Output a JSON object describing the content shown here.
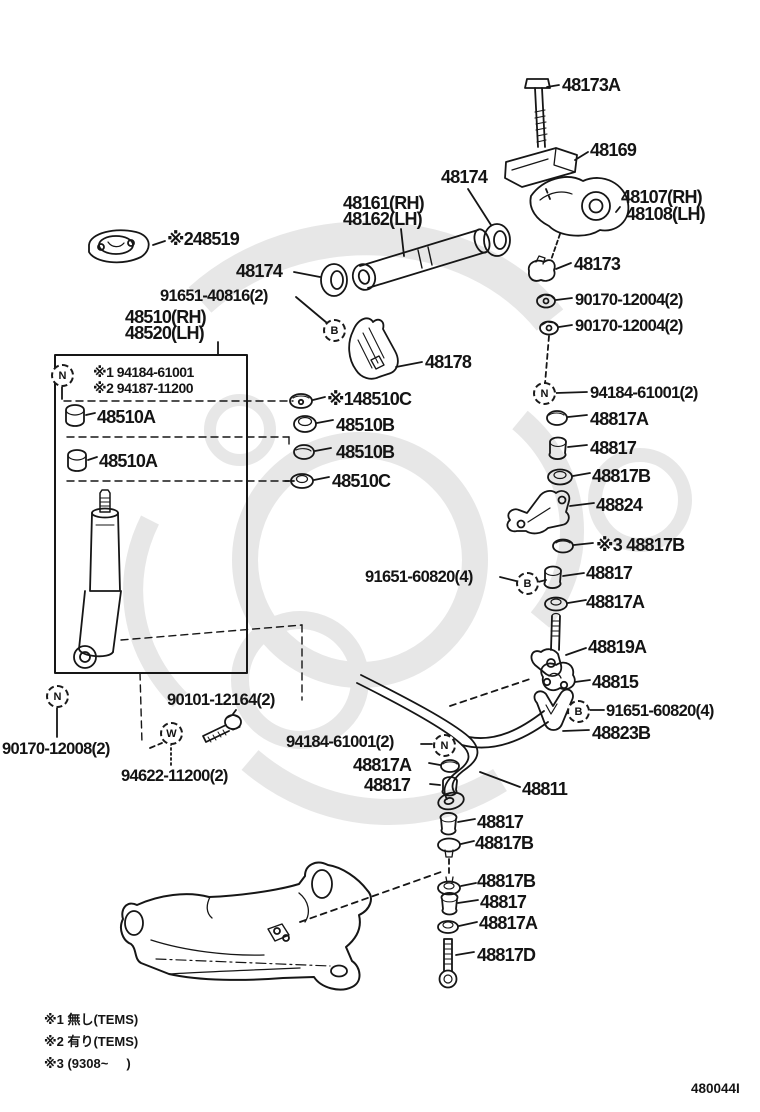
{
  "figure": {
    "code": "480044I"
  },
  "labels": [
    {
      "text": "48173A"
    },
    {
      "text": "48169"
    },
    {
      "text": "48174"
    },
    {
      "text": "48161(RH)"
    },
    {
      "text": "48162(LH)"
    },
    {
      "text": "48107(RH)"
    },
    {
      "text": "48108(LH)"
    },
    {
      "text": "※248519"
    },
    {
      "text": "48174"
    },
    {
      "text": "48173"
    },
    {
      "text": "91651-40816(2)"
    },
    {
      "text": "90170-12004(2)"
    },
    {
      "text": "90170-12004(2)"
    },
    {
      "text": "48510(RH)"
    },
    {
      "text": "48520(LH)"
    },
    {
      "text": "48178"
    },
    {
      "text": "※1 94184-61001"
    },
    {
      "text": "※2 94187-11200"
    },
    {
      "text": "※148510C"
    },
    {
      "text": "48510B"
    },
    {
      "text": "48510A"
    },
    {
      "text": "48510B"
    },
    {
      "text": "48510A"
    },
    {
      "text": "48510C"
    },
    {
      "text": "94184-61001(2)"
    },
    {
      "text": "48817A"
    },
    {
      "text": "48817"
    },
    {
      "text": "48817B"
    },
    {
      "text": "48824"
    },
    {
      "text": "※3 48817B"
    },
    {
      "text": "91651-60820(4)"
    },
    {
      "text": "48817"
    },
    {
      "text": "48817A"
    },
    {
      "text": "48819A"
    },
    {
      "text": "48815"
    },
    {
      "text": "91651-60820(4)"
    },
    {
      "text": "48823B"
    },
    {
      "text": "90101-12164(2)"
    },
    {
      "text": "90170-12008(2)"
    },
    {
      "text": "94622-11200(2)"
    },
    {
      "text": "94184-61001(2)"
    },
    {
      "text": "48817A"
    },
    {
      "text": "48817"
    },
    {
      "text": "48811"
    },
    {
      "text": "48817"
    },
    {
      "text": "48817B"
    },
    {
      "text": "48817B"
    },
    {
      "text": "48817"
    },
    {
      "text": "48817A"
    },
    {
      "text": "48817D"
    }
  ],
  "callouts": [
    {
      "letter": "N"
    },
    {
      "letter": "B"
    },
    {
      "letter": "N"
    },
    {
      "letter": "B"
    },
    {
      "letter": "B"
    },
    {
      "letter": "N"
    },
    {
      "letter": "W"
    },
    {
      "letter": "N"
    }
  ],
  "notes": [
    {
      "text": "※1 無し(TEMS)"
    },
    {
      "text": "※2 有り(TEMS)"
    },
    {
      "text": "※3 (9308~     )"
    }
  ]
}
